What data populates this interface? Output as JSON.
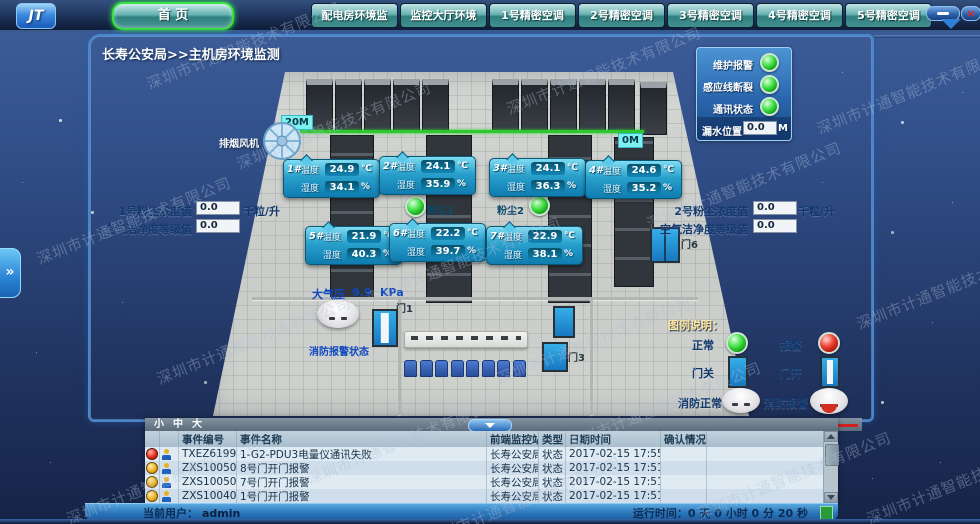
{
  "window": {
    "logo": "JT",
    "close": "×"
  },
  "nav": {
    "home": "首 页",
    "tabs": [
      "配电房环境监",
      "监控大厅环境",
      "1号精密空调",
      "2号精密空调",
      "3号精密空调",
      "4号精密空调",
      "5号精密空调"
    ]
  },
  "title": "长寿公安局>>主机房环境监测",
  "status_panel": {
    "rows": [
      {
        "label": "维护报警",
        "state": "normal"
      },
      {
        "label": "感应线断裂",
        "state": "normal"
      },
      {
        "label": "通讯状态",
        "state": "normal"
      }
    ],
    "leak": {
      "label": "漏水位置",
      "value": "0.0",
      "unit": "M"
    }
  },
  "room": {
    "fan_label": "排烟风机",
    "cable": {
      "start": "20M",
      "end": "0M"
    },
    "temp_label": "温度",
    "hum_label": "湿度",
    "temp_unit": "℃",
    "hum_unit": "%",
    "sensors": [
      {
        "id": "1#",
        "temp": "24.9",
        "hum": "34.1"
      },
      {
        "id": "2#",
        "temp": "24.1",
        "hum": "35.9"
      },
      {
        "id": "3#",
        "temp": "24.1",
        "hum": "36.3"
      },
      {
        "id": "4#",
        "temp": "24.6",
        "hum": "35.2"
      },
      {
        "id": "5#",
        "temp": "21.9",
        "hum": "40.3"
      },
      {
        "id": "6#",
        "temp": "22.2",
        "hum": "39.7"
      },
      {
        "id": "7#",
        "temp": "22.9",
        "hum": "38.1"
      }
    ],
    "dust1": "粉尘1",
    "dust2": "粉尘2",
    "pressure": {
      "label": "大气压",
      "value": "9.9",
      "unit": "KPa"
    },
    "fire_label": "消防报警状态",
    "door1": "门1",
    "door3": "门3",
    "door6": "门6"
  },
  "dust_left": {
    "row1": {
      "label": "1号粉尘浓度值",
      "value": "0.0",
      "unit": "千粒/升"
    },
    "row2": {
      "label": "空气洁净度等级值",
      "value": "0.0"
    }
  },
  "dust_right": {
    "row1": {
      "label": "2号粉尘浓度值",
      "value": "0.0",
      "unit": "千粒/升"
    },
    "row2": {
      "label": "空气洁净度等级值",
      "value": "0.0"
    }
  },
  "legend": {
    "title": "图例说明：",
    "normal": "正常",
    "alarm": "报警",
    "door_closed": "门关",
    "door_open": "门开",
    "fire_normal": "消防正常",
    "fire_alarm": "消防报警",
    "leak_normal": "漏水正常",
    "leak_alarm": "漏水报警"
  },
  "events": {
    "font_sizes": [
      "小",
      "中",
      "大"
    ],
    "headers": [
      "事件编号",
      "事件名称",
      "前端监控站",
      "类型",
      "日期时间",
      "确认情况"
    ],
    "rows": [
      {
        "severity": "red",
        "id": "TXEZ619999",
        "name": "1-G2-PDU3电量仪通讯失败",
        "station": "长寿公安局",
        "type": "状态",
        "datetime": "2017-02-15 17:55:35",
        "ack": ""
      },
      {
        "severity": "yellow",
        "id": "ZXS1005012",
        "name": "8号门开门报警",
        "station": "长寿公安局",
        "type": "状态",
        "datetime": "2017-02-15 17:51:44",
        "ack": ""
      },
      {
        "severity": "yellow",
        "id": "ZXS1005011",
        "name": "7号门开门报警",
        "station": "长寿公安局",
        "type": "状态",
        "datetime": "2017-02-15 17:51:44",
        "ack": ""
      },
      {
        "severity": "yellow",
        "id": "ZXS1004011",
        "name": "1号门开门报警",
        "station": "长寿公安局",
        "type": "状态",
        "datetime": "2017-02-15 17:51:31",
        "ack": ""
      }
    ]
  },
  "statusbar": {
    "user_label": "当前用户：",
    "user": "admin",
    "runtime": "运行时间：0 天 0 小时 0 分 20 秒"
  },
  "watermark": "深圳市计通智能技术有限公司",
  "colors": {
    "accent_teal": "#5aacac",
    "led_green": "#2ecc40",
    "led_red": "#e03030",
    "cable_green": "#2ec82e",
    "alarm_yellow": "#f0b428",
    "sensor_cyan": "#29a0cc"
  }
}
